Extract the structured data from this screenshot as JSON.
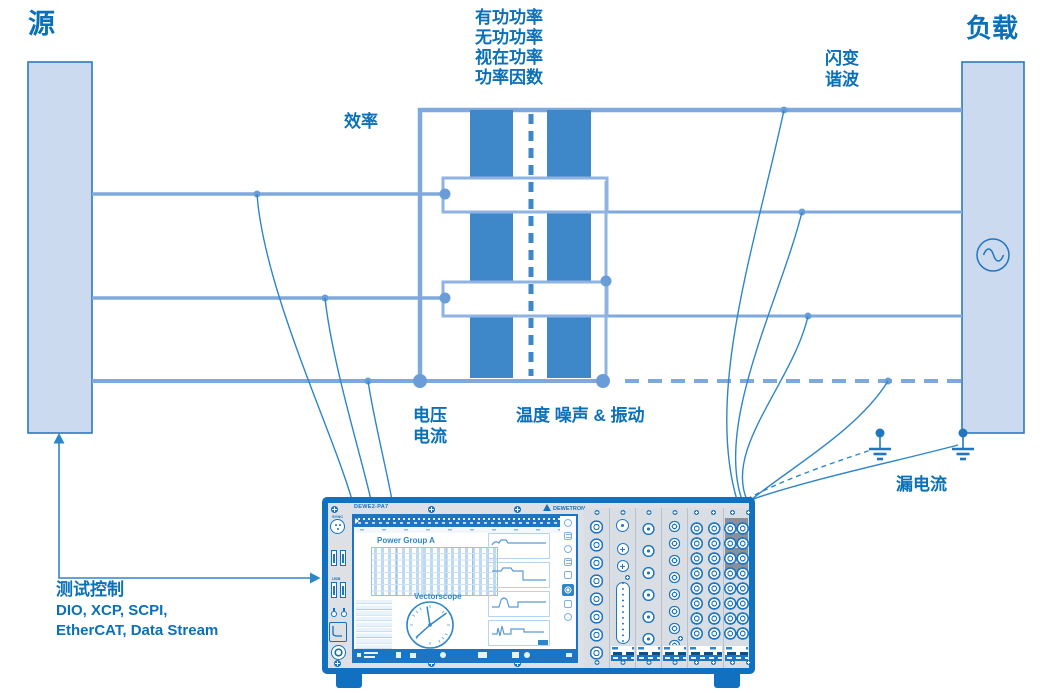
{
  "diagram": {
    "source_label": "源",
    "load_label": "负载",
    "power_measurements": [
      "有功功率",
      "无功功率",
      "视在功率",
      "功率因数"
    ],
    "efficiency_label": "效率",
    "flicker_label": "闪变",
    "harmonics_label": "谐波",
    "voltage_label": "电压",
    "current_label": "电流",
    "temp_noise_label": "温度 噪声 & 振动",
    "leakage_label": "漏电流",
    "test_control": {
      "title": "测试控制",
      "protocols_line1": "DIO, XCP, SCPI,",
      "protocols_line2": "EtherCAT, Data Stream"
    }
  },
  "instrument": {
    "model": "DEWE2-PA7",
    "brand": "DEWETRON",
    "front_labels": {
      "sync": "SYNC",
      "usb": "USB"
    },
    "screen": {
      "power_group_title": "Power Group A",
      "vectorscope_title": "Vectorscope"
    }
  },
  "colors": {
    "label_text": "#0a70b8",
    "power_line": "#7fa9dd",
    "bar_fill": "#3e87c8",
    "measurement_wire": "#2e86c8",
    "box_fill": "#ccdaef",
    "box_border": "#2e79bd",
    "instrument_frame": "#1170c0",
    "panel_gray": "#dde1e6"
  }
}
